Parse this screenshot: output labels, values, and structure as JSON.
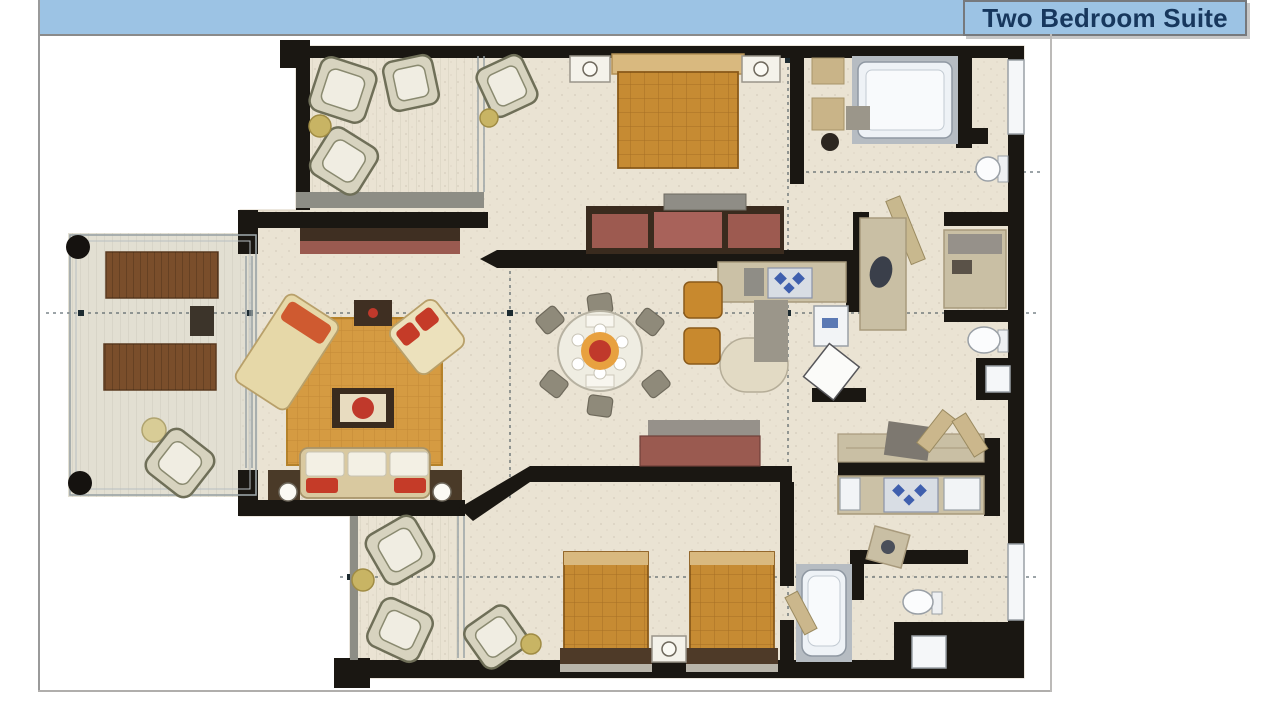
{
  "header": {
    "title": "Two Bedroom Suite",
    "bar_color": "#9CC3E4",
    "title_text_color": "#17375D",
    "border_color": "#76797d"
  },
  "plan": {
    "type": "floor-plan",
    "wall_color": "#1a1712",
    "floor_color": "#EAE3D3",
    "accent_wood_color": "#C68B33",
    "rug_color": "#D59B42",
    "pillow_red": "#C53B28",
    "rooms": [
      "master-bedroom",
      "master-bathroom",
      "kitchenette-upper",
      "dining-area",
      "living-room",
      "left-terrace",
      "top-balcony",
      "bottom-balcony",
      "second-bedroom",
      "second-bathroom",
      "kitchenette-lower",
      "entry-corridor"
    ],
    "furniture": [
      "king-bed",
      "twin-bed",
      "twin-bed",
      "sofa",
      "chaise",
      "armchair",
      "dining-table",
      "dining-chairs",
      "coffee-table",
      "dresser-tv",
      "console",
      "shower",
      "bathtub",
      "toilet",
      "toilet",
      "toilet",
      "vanity",
      "lounge-chair",
      "lounge-chair",
      "wicker-chairs",
      "bar-counter",
      "stove",
      "fridge",
      "closet"
    ]
  }
}
